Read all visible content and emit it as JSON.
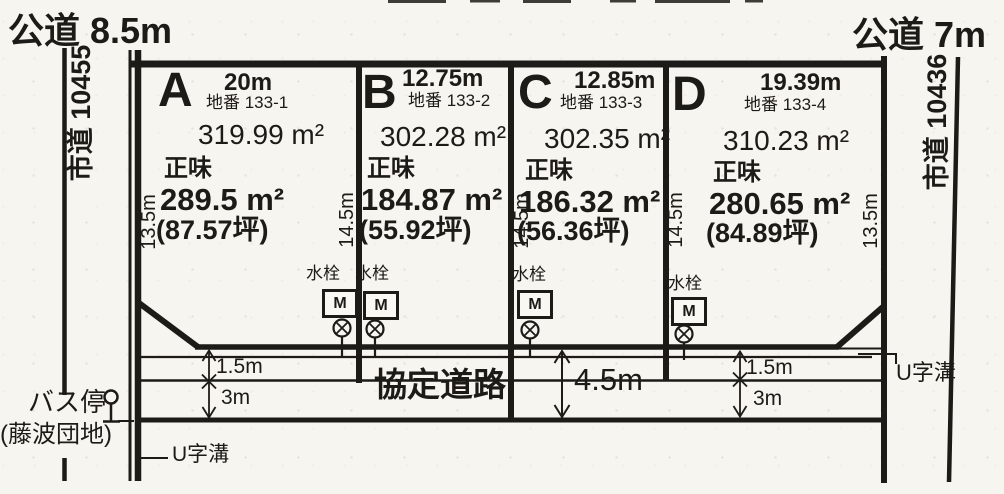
{
  "canvas": {
    "width": 1004,
    "height": 494
  },
  "top_roads": {
    "left": "公道 8.5m",
    "right": "公道 7m"
  },
  "side_roads": {
    "left": "市道 10455",
    "right": "市道 10436"
  },
  "plots": [
    {
      "id": "A",
      "frontage": "20m",
      "lot_no": "地番 133-1",
      "gross": "319.99 m²",
      "net_label": "正味",
      "net": "289.5 m²",
      "tsubo": "(87.57坪)"
    },
    {
      "id": "B",
      "frontage": "12.75m",
      "lot_no": "地番 133-2",
      "gross": "302.28 m²",
      "net_label": "正味",
      "net": "184.87 m²",
      "tsubo": "(55.92坪)"
    },
    {
      "id": "C",
      "frontage": "12.85m",
      "lot_no": "地番 133-3",
      "gross": "302.35 m²",
      "net_label": "正味",
      "net": "186.32 m²",
      "tsubo": "(56.36坪)"
    },
    {
      "id": "D",
      "frontage": "19.39m",
      "lot_no": "地番 133-4",
      "gross": "310.23 m²",
      "net_label": "正味",
      "net": "280.65 m²",
      "tsubo": "(84.89坪)"
    }
  ],
  "side_dims": [
    "13.5m",
    "14.5m",
    "14.5m",
    "14.5m",
    "13.5m"
  ],
  "water_tap": {
    "label": "水栓",
    "meter": "M"
  },
  "road_area": {
    "name": "協定道路",
    "total_width": "4.5m",
    "left_dims": {
      "strip1": "1.5m",
      "strip2": "3m"
    },
    "right_dims": {
      "strip1": "1.5m",
      "strip2": "3m"
    }
  },
  "bus_stop": {
    "label": "バス停",
    "name": "(藤波団地)"
  },
  "gutter": {
    "left": "U字溝",
    "right": "U字溝"
  },
  "ink": "#1d1b18"
}
